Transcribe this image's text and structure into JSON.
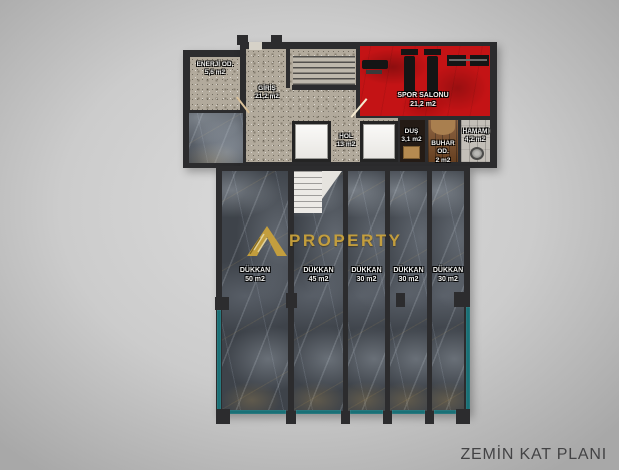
{
  "title": {
    "text": "ZEMİN KAT PLANI"
  },
  "watermark": {
    "text": "PROPERTY",
    "logo": "gold-mountain-A"
  },
  "rooms": [
    {
      "name": "ENERJİ OD.",
      "area": "5,6 m2"
    },
    {
      "name": "GİRİŞ",
      "area": "21,2 m2"
    },
    {
      "name": "SPOR SALONU",
      "area": "21,2 m2"
    },
    {
      "name": "HOL",
      "area": "13 m2"
    },
    {
      "name": "DUŞ",
      "area": "3,1 m2"
    },
    {
      "name": "BUHAR OD.",
      "area": "2 m2"
    },
    {
      "name": "HAMAM",
      "area": "4,2 m2"
    },
    {
      "name": "DÜKKAN",
      "area": "50 m2"
    },
    {
      "name": "DÜKKAN",
      "area": "45 m2"
    },
    {
      "name": "DÜKKAN",
      "area": "30 m2"
    },
    {
      "name": "DÜKKAN",
      "area": "30 m2"
    },
    {
      "name": "DÜKKAN",
      "area": "30 m2"
    }
  ],
  "colors": {
    "gym_red": "#c41315",
    "marble_base": "#3e434a",
    "granite_base": "#b2aa9c",
    "glass_teal": "#1a7076",
    "watermark_gold": "#c9a23c",
    "wall": "#2c2c2e"
  }
}
